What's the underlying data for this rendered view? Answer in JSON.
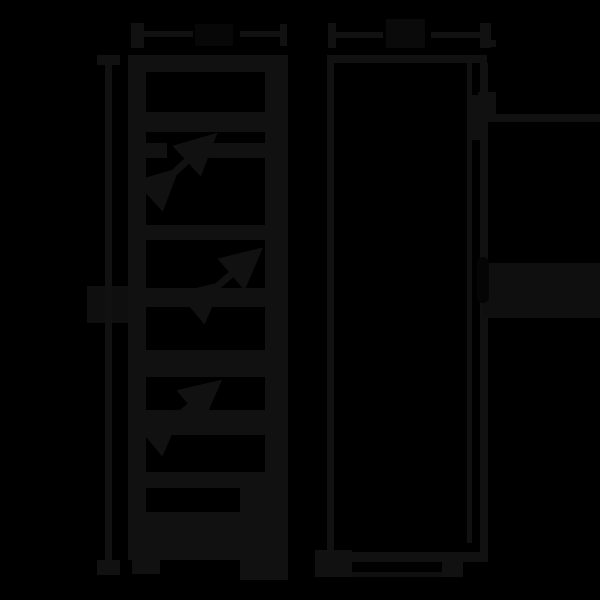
{
  "canvas": {
    "width": 600,
    "height": 600,
    "description": "very dark technical dimension diagram of tall appliance, front and side views"
  },
  "palette": {
    "background": "#000000",
    "ink": "#111111",
    "ink_dim": "#0f0f0f",
    "ink_faint": "#0a0a0a",
    "ink_ghost": "#070707",
    "ink_shadow": "#050505"
  },
  "drawing": {
    "rects": [
      {
        "name": "width-dim-left-arrow",
        "x": 131,
        "y": 23,
        "w": 13,
        "h": 25,
        "color": "ink"
      },
      {
        "name": "width-dim-line-left",
        "x": 144,
        "y": 31,
        "w": 49,
        "h": 6,
        "color": "ink"
      },
      {
        "name": "width-dim-label-blob",
        "x": 195,
        "y": 24,
        "w": 38,
        "h": 22,
        "color": "ink_ghost"
      },
      {
        "name": "width-dim-line-right",
        "x": 240,
        "y": 31,
        "w": 40,
        "h": 6,
        "color": "ink"
      },
      {
        "name": "width-dim-right-tick",
        "x": 280,
        "y": 24,
        "w": 7,
        "h": 22,
        "color": "ink"
      },
      {
        "name": "depth-dim-left-tick",
        "x": 328,
        "y": 23,
        "w": 8,
        "h": 25,
        "color": "ink"
      },
      {
        "name": "depth-dim-line-left",
        "x": 336,
        "y": 32,
        "w": 47,
        "h": 6,
        "color": "ink"
      },
      {
        "name": "depth-dim-label-blob",
        "x": 386,
        "y": 19,
        "w": 39,
        "h": 29,
        "color": "ink_faint"
      },
      {
        "name": "depth-dim-line-right",
        "x": 431,
        "y": 32,
        "w": 49,
        "h": 6,
        "color": "ink"
      },
      {
        "name": "depth-dim-right-arrow",
        "x": 480,
        "y": 23,
        "w": 11,
        "h": 25,
        "color": "ink"
      },
      {
        "name": "depth-dim-right-nub",
        "x": 491,
        "y": 40,
        "w": 5,
        "h": 7,
        "color": "ink"
      },
      {
        "name": "height-dim-top-tick",
        "x": 97,
        "y": 55,
        "w": 23,
        "h": 10,
        "color": "ink"
      },
      {
        "name": "height-dim-line",
        "x": 105,
        "y": 55,
        "w": 7,
        "h": 520,
        "color": "ink"
      },
      {
        "name": "height-dim-bottom-tick",
        "x": 97,
        "y": 560,
        "w": 23,
        "h": 15,
        "color": "ink"
      },
      {
        "name": "height-dim-label-blob-left",
        "x": 87,
        "y": 286,
        "w": 18,
        "h": 37,
        "color": "ink_dim"
      },
      {
        "name": "height-dim-label-blob-right",
        "x": 112,
        "y": 286,
        "w": 16,
        "h": 37,
        "color": "ink_dim"
      },
      {
        "name": "front-view-top-edge",
        "x": 128,
        "y": 55,
        "w": 160,
        "h": 17,
        "color": "ink"
      },
      {
        "name": "front-view-left-wall",
        "x": 128,
        "y": 55,
        "w": 18,
        "h": 505,
        "color": "ink"
      },
      {
        "name": "front-view-right-wall",
        "x": 265,
        "y": 55,
        "w": 23,
        "h": 505,
        "color": "ink"
      },
      {
        "name": "front-view-divider-band",
        "x": 146,
        "y": 112,
        "w": 119,
        "h": 20,
        "color": "ink"
      },
      {
        "name": "front-view-shelf1-left",
        "x": 146,
        "y": 143,
        "w": 21,
        "h": 15,
        "color": "ink"
      },
      {
        "name": "front-view-shelf1-right",
        "x": 207,
        "y": 143,
        "w": 58,
        "h": 15,
        "color": "ink"
      },
      {
        "name": "front-view-shelf2",
        "x": 146,
        "y": 225,
        "w": 119,
        "h": 15,
        "color": "ink"
      },
      {
        "name": "front-view-shelf3",
        "x": 146,
        "y": 288,
        "w": 119,
        "h": 19,
        "color": "ink"
      },
      {
        "name": "front-view-shelf4",
        "x": 146,
        "y": 350,
        "w": 119,
        "h": 27,
        "color": "ink"
      },
      {
        "name": "front-view-shelf5",
        "x": 146,
        "y": 410,
        "w": 119,
        "h": 25,
        "color": "ink"
      },
      {
        "name": "front-view-shelf6",
        "x": 146,
        "y": 472,
        "w": 119,
        "h": 16,
        "color": "ink"
      },
      {
        "name": "front-view-right-column-lower",
        "x": 240,
        "y": 488,
        "w": 25,
        "h": 60,
        "color": "ink"
      },
      {
        "name": "front-view-drawer-slab",
        "x": 146,
        "y": 512,
        "w": 119,
        "h": 36,
        "color": "ink"
      },
      {
        "name": "front-view-bottom-edge",
        "x": 128,
        "y": 548,
        "w": 160,
        "h": 12,
        "color": "ink"
      },
      {
        "name": "front-view-left-foot",
        "x": 132,
        "y": 560,
        "w": 28,
        "h": 14,
        "color": "ink"
      },
      {
        "name": "front-view-right-foot",
        "x": 240,
        "y": 560,
        "w": 48,
        "h": 20,
        "color": "ink"
      },
      {
        "name": "side-view-top-edge",
        "x": 327,
        "y": 55,
        "w": 160,
        "h": 8,
        "color": "ink"
      },
      {
        "name": "side-view-left-wall",
        "x": 327,
        "y": 55,
        "w": 7,
        "h": 500,
        "color": "ink"
      },
      {
        "name": "side-view-door-inner-line",
        "x": 467,
        "y": 63,
        "w": 5,
        "h": 480,
        "color": "ink"
      },
      {
        "name": "side-view-right-wall",
        "x": 480,
        "y": 63,
        "w": 8,
        "h": 499,
        "color": "ink"
      },
      {
        "name": "side-view-hinge-block",
        "x": 467,
        "y": 95,
        "w": 21,
        "h": 45,
        "color": "ink"
      },
      {
        "name": "side-view-hinge-stub",
        "x": 478,
        "y": 92,
        "w": 18,
        "h": 30,
        "color": "ink"
      },
      {
        "name": "side-view-wall-line-right",
        "x": 496,
        "y": 114,
        "w": 104,
        "h": 8,
        "color": "ink"
      },
      {
        "name": "side-view-handle-band",
        "x": 483,
        "y": 263,
        "w": 117,
        "h": 55,
        "color": "ink_dim"
      },
      {
        "name": "side-view-handle-recess",
        "x": 477,
        "y": 257,
        "w": 12,
        "h": 46,
        "color": "ink_shadow",
        "radius": 6
      },
      {
        "name": "side-view-bottom-edge",
        "x": 327,
        "y": 552,
        "w": 156,
        "h": 10,
        "color": "ink"
      },
      {
        "name": "side-view-front-foot",
        "x": 315,
        "y": 550,
        "w": 37,
        "h": 27,
        "color": "ink"
      },
      {
        "name": "side-view-rear-foot",
        "x": 442,
        "y": 562,
        "w": 21,
        "h": 15,
        "color": "ink"
      },
      {
        "name": "side-view-bottom-line",
        "x": 352,
        "y": 572,
        "w": 90,
        "h": 5,
        "color": "ink_dim"
      }
    ],
    "arrows": [
      {
        "name": "shelf-adjust-arrow-1",
        "x1": 164,
        "y1": 182,
        "x2": 202,
        "y2": 147
      },
      {
        "name": "shelf-adjust-arrow-2",
        "x1": 207,
        "y1": 295,
        "x2": 247,
        "y2": 261
      },
      {
        "name": "shelf-adjust-arrow-3",
        "x1": 165,
        "y1": 427,
        "x2": 206,
        "y2": 393
      }
    ],
    "arrow_color": "ink",
    "arrow_stroke_width": 7
  }
}
